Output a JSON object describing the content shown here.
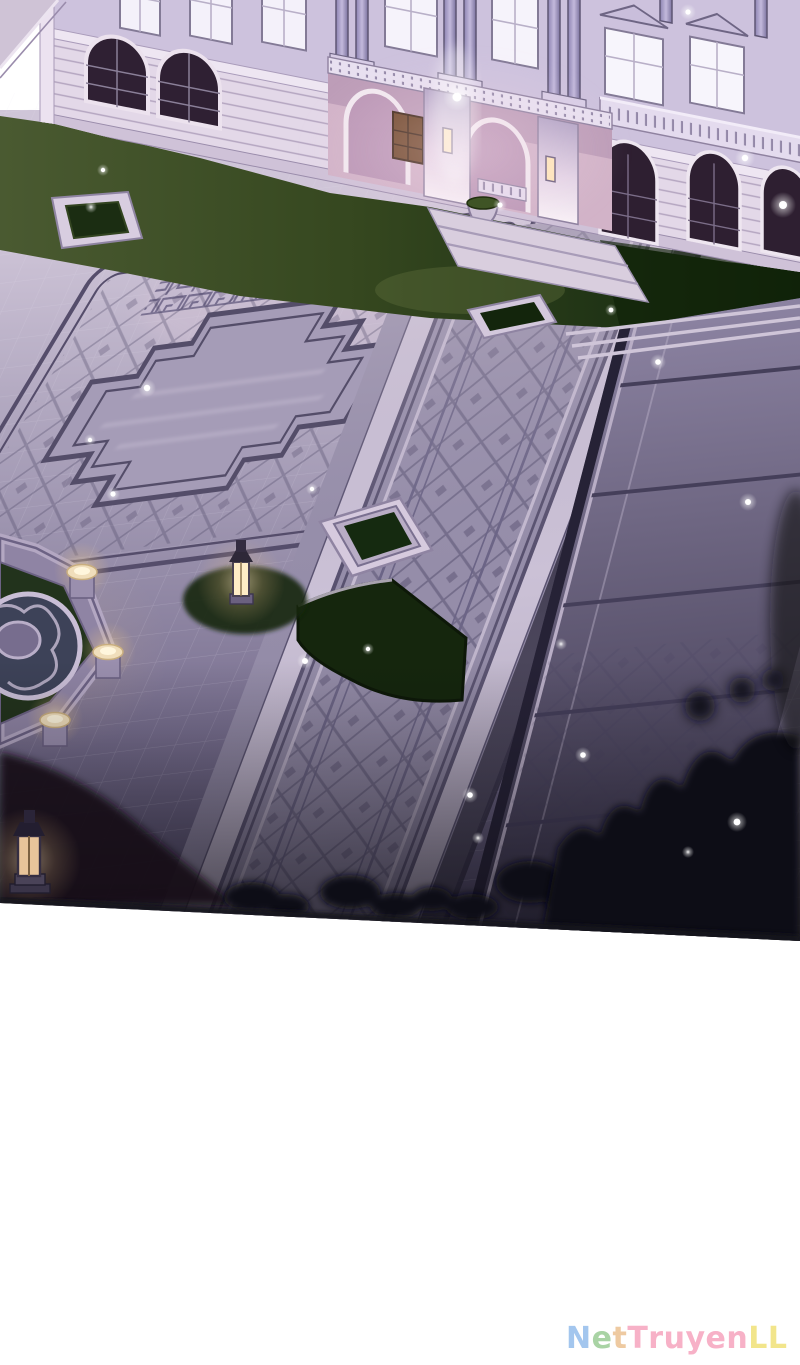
{
  "panel": {
    "type": "webtoon-page-illustration",
    "scene": "Aerial night view of a palace courtyard: lit palace facade at top, lawns, huge lavender stone plaza with greek-key borders, a stepped-cross medallion, a long lattice-paved walkway, terraces, an octagonal fountain with glowing lamp bollards, stone lanterns, fireflies and dark tree silhouettes at the bottom edge",
    "colors": {
      "pavement_light": "#cfc5d8",
      "pavement_mid": "#978ea9",
      "pavement_dark": "#4a4460",
      "pattern_line": "#57506e",
      "lawn_light": "#4a5a31",
      "lawn_dark": "#16280f",
      "building_wall": "#e3d8e8",
      "building_upper": "#cdc2dd",
      "window_lit": "#f4f1fa",
      "window_dark": "#2f2033",
      "portico_pink": "#d2b3c8",
      "lantern_glow": "#ffe9c0",
      "fountain_water": "#3d4258",
      "foliage_silhouette": "#0c0b15",
      "page_background": "#ffffff"
    },
    "elements": [
      "palace-facade",
      "portico",
      "lit-windows",
      "arched-windows",
      "lawn",
      "greek-key-border",
      "central-medallion",
      "lattice-walkway",
      "terrace",
      "steps",
      "planter-boxes",
      "fountain",
      "lamp-bollards",
      "stone-lanterns",
      "wall-sconces",
      "tree-silhouettes",
      "sparkles"
    ]
  },
  "watermark": {
    "text": "NetTruyenLL",
    "letters": [
      {
        "char": "N",
        "color": "#a3c6ee"
      },
      {
        "char": "e",
        "color": "#a9d3a4"
      },
      {
        "char": "t",
        "color": "#eecaa1"
      },
      {
        "char": "T",
        "color": "#f7b1c7"
      },
      {
        "char": "r",
        "color": "#f7b1c7"
      },
      {
        "char": "u",
        "color": "#f7b1c7"
      },
      {
        "char": "y",
        "color": "#f7b1c7"
      },
      {
        "char": "e",
        "color": "#f7b1c7"
      },
      {
        "char": "n",
        "color": "#f7b1c7"
      },
      {
        "char": "L",
        "color": "#f2e58b"
      },
      {
        "char": "L",
        "color": "#f2e58b"
      }
    ]
  }
}
